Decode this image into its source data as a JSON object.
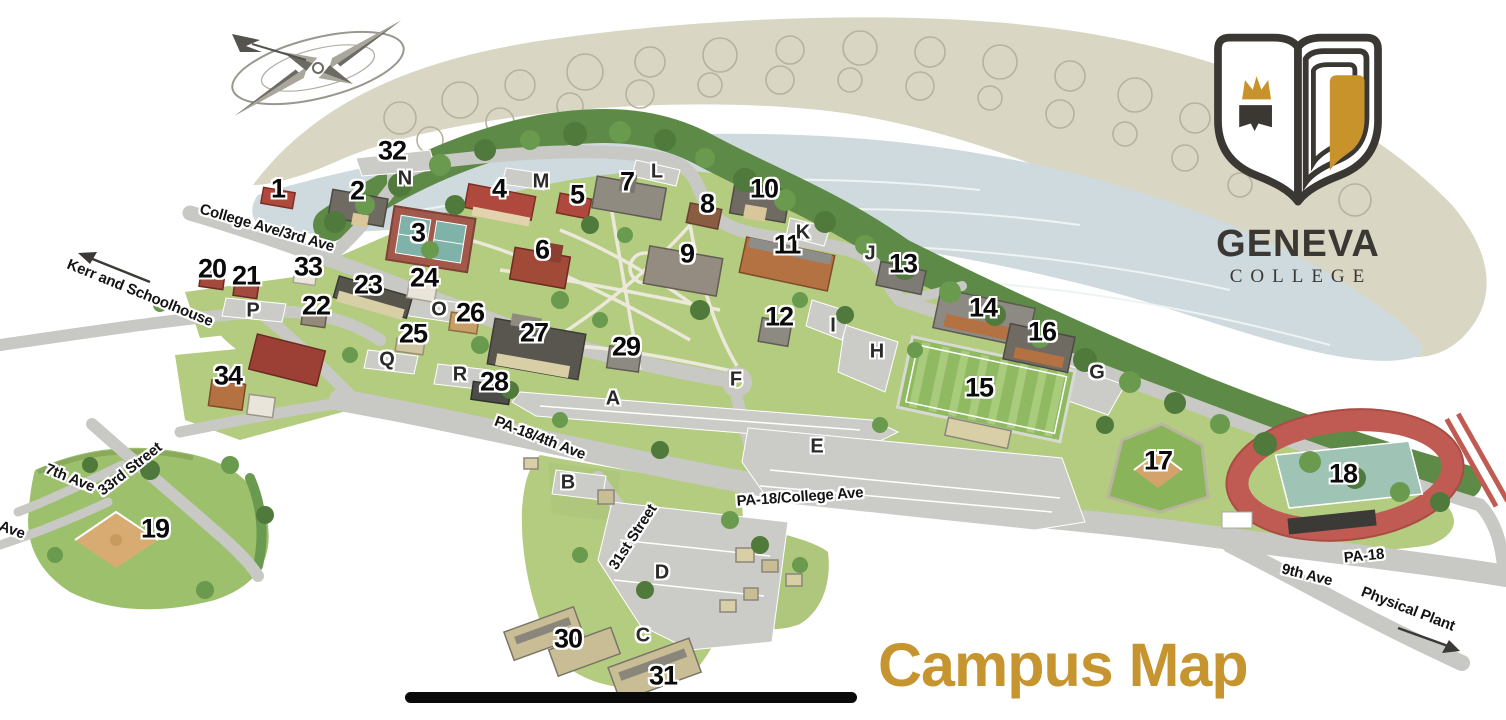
{
  "logo": {
    "alt": "Geneva College shield logo",
    "line1": "GENEVA",
    "line2": "COLLEGE",
    "colors": {
      "outline": "#3B3834",
      "gold": "#C9932B"
    }
  },
  "title": {
    "text": "Campus Map",
    "color": "#C6952F"
  },
  "map": {
    "building_numbers": [
      {
        "n": "1",
        "x": 278,
        "y": 189
      },
      {
        "n": "2",
        "x": 357,
        "y": 191
      },
      {
        "n": "3",
        "x": 418,
        "y": 233
      },
      {
        "n": "4",
        "x": 499,
        "y": 189
      },
      {
        "n": "5",
        "x": 577,
        "y": 195
      },
      {
        "n": "6",
        "x": 542,
        "y": 250
      },
      {
        "n": "7",
        "x": 627,
        "y": 182
      },
      {
        "n": "8",
        "x": 707,
        "y": 204
      },
      {
        "n": "9",
        "x": 687,
        "y": 254
      },
      {
        "n": "10",
        "x": 764,
        "y": 189
      },
      {
        "n": "11",
        "x": 787,
        "y": 245
      },
      {
        "n": "12",
        "x": 779,
        "y": 317
      },
      {
        "n": "13",
        "x": 903,
        "y": 264
      },
      {
        "n": "14",
        "x": 983,
        "y": 308
      },
      {
        "n": "15",
        "x": 979,
        "y": 388
      },
      {
        "n": "16",
        "x": 1042,
        "y": 332
      },
      {
        "n": "17",
        "x": 1158,
        "y": 461
      },
      {
        "n": "18",
        "x": 1343,
        "y": 474
      },
      {
        "n": "19",
        "x": 155,
        "y": 529
      },
      {
        "n": "20",
        "x": 212,
        "y": 269
      },
      {
        "n": "21",
        "x": 246,
        "y": 276
      },
      {
        "n": "22",
        "x": 316,
        "y": 306
      },
      {
        "n": "23",
        "x": 368,
        "y": 285
      },
      {
        "n": "24",
        "x": 424,
        "y": 278
      },
      {
        "n": "25",
        "x": 413,
        "y": 334
      },
      {
        "n": "26",
        "x": 470,
        "y": 313
      },
      {
        "n": "27",
        "x": 534,
        "y": 333
      },
      {
        "n": "28",
        "x": 494,
        "y": 382
      },
      {
        "n": "29",
        "x": 626,
        "y": 347
      },
      {
        "n": "30",
        "x": 568,
        "y": 639
      },
      {
        "n": "31",
        "x": 663,
        "y": 676
      },
      {
        "n": "32",
        "x": 392,
        "y": 151
      },
      {
        "n": "33",
        "x": 308,
        "y": 267
      },
      {
        "n": "34",
        "x": 228,
        "y": 376
      }
    ],
    "area_letters": [
      {
        "n": "A",
        "x": 613,
        "y": 399
      },
      {
        "n": "B",
        "x": 568,
        "y": 483
      },
      {
        "n": "C",
        "x": 643,
        "y": 636
      },
      {
        "n": "D",
        "x": 662,
        "y": 573
      },
      {
        "n": "E",
        "x": 817,
        "y": 447
      },
      {
        "n": "F",
        "x": 736,
        "y": 380
      },
      {
        "n": "G",
        "x": 1097,
        "y": 373
      },
      {
        "n": "H",
        "x": 877,
        "y": 352
      },
      {
        "n": "I",
        "x": 833,
        "y": 326
      },
      {
        "n": "J",
        "x": 870,
        "y": 254
      },
      {
        "n": "K",
        "x": 803,
        "y": 233
      },
      {
        "n": "L",
        "x": 657,
        "y": 172
      },
      {
        "n": "M",
        "x": 541,
        "y": 182
      },
      {
        "n": "N",
        "x": 405,
        "y": 179
      },
      {
        "n": "O",
        "x": 439,
        "y": 310
      },
      {
        "n": "P",
        "x": 253,
        "y": 311
      },
      {
        "n": "Q",
        "x": 387,
        "y": 360
      },
      {
        "n": "R",
        "x": 460,
        "y": 375
      }
    ],
    "street_labels": [
      {
        "text": "College Ave/3rd Ave",
        "x": 267,
        "y": 228,
        "rot": 16
      },
      {
        "text": "Kerr and Schoolhouse",
        "x": 140,
        "y": 293,
        "rot": 22
      },
      {
        "text": "PA-18/4th Ave",
        "x": 540,
        "y": 438,
        "rot": 21
      },
      {
        "text": "PA-18/College Ave",
        "x": 800,
        "y": 497,
        "rot": -4
      },
      {
        "text": "31st Street",
        "x": 633,
        "y": 537,
        "rot": -57
      },
      {
        "text": "33rd Street",
        "x": 130,
        "y": 469,
        "rot": -38
      },
      {
        "text": "7th Ave",
        "x": 70,
        "y": 478,
        "rot": 22
      },
      {
        "text": "Ave",
        "x": 12,
        "y": 530,
        "rot": 20
      },
      {
        "text": "PA-18",
        "x": 1364,
        "y": 556,
        "rot": -6
      },
      {
        "text": "9th Ave",
        "x": 1307,
        "y": 575,
        "rot": 14
      },
      {
        "text": "Physical Plant",
        "x": 1408,
        "y": 609,
        "rot": 21
      }
    ],
    "features": [
      "compass-rose",
      "river",
      "tree-line",
      "tennis-courts",
      "practice-field",
      "baseball-field",
      "track-and-field",
      "parking-lots",
      "divider-bar"
    ]
  }
}
